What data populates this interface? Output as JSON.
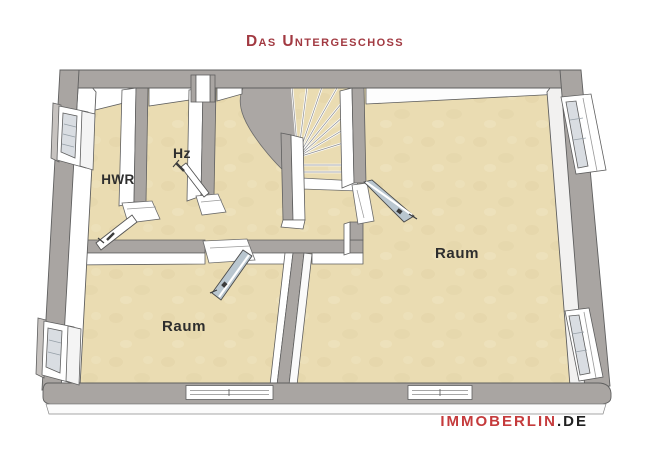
{
  "header": {
    "title": "Das Untergeschoss"
  },
  "floorplan": {
    "rooms": [
      {
        "id": "hwr",
        "label": "HWR"
      },
      {
        "id": "hz",
        "label": "Hz"
      },
      {
        "id": "raum-right",
        "label": "Raum"
      },
      {
        "id": "raum-left",
        "label": "Raum"
      }
    ],
    "colors": {
      "floor": "#EADCB2",
      "wall_top": "#A9A5A2",
      "wall_face": "#FFFFFF",
      "door_glass": "#B9C6CF",
      "outline": "#5F5F5F",
      "title_red": "#A23A42",
      "label_color": "#2E2E2E"
    }
  },
  "footer": {
    "brand": "IMMOBERLIN",
    "tld": ".DE"
  }
}
